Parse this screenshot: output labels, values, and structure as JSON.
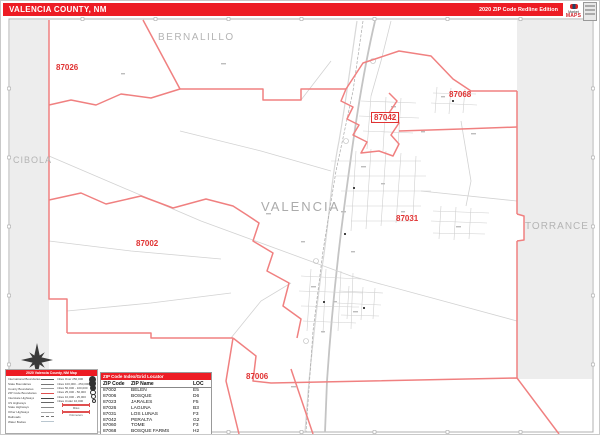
{
  "header": {
    "title": "VALENCIA COUNTY, NM",
    "edition": "2020 ZIP Code Redline Edition"
  },
  "logo": {
    "brand_top": "Market",
    "brand_bottom": "MAPS"
  },
  "map": {
    "county_labels": [
      {
        "id": "bernalillo",
        "text": "BERNALILLO"
      },
      {
        "id": "cibola",
        "text": "CIBOLA"
      },
      {
        "id": "torrance",
        "text": "TORRANCE"
      },
      {
        "id": "valencia",
        "text": "VALENCIA"
      }
    ],
    "zip_labels": [
      {
        "id": "87026",
        "text": "87026"
      },
      {
        "id": "87042",
        "text": "87042"
      },
      {
        "id": "87068",
        "text": "87068"
      },
      {
        "id": "87031",
        "text": "87031"
      },
      {
        "id": "87002",
        "text": "87002"
      },
      {
        "id": "87006",
        "text": "87006"
      }
    ]
  },
  "legend": {
    "title": "2020 Valencia County, NM Map",
    "left_items": [
      "International Boundaries",
      "State Boundaries",
      "County Boundaries",
      "ZIP Code Boundaries",
      "Interstate Highways",
      "US Highways",
      "State Highways",
      "Other Highways",
      "Railroads",
      "Water Bodies"
    ],
    "city_items": [
      "Cities Over 250,000",
      "Cities 100,000 - 250,000",
      "Cities 50,000 - 100,000",
      "Cities 25,000 - 50,000",
      "Cities 10,000 - 25,000",
      "Cities Under 10,000"
    ],
    "scale_labels": [
      "Miles",
      "Kilometers"
    ]
  },
  "zip_table": {
    "header": "ZIP Code Index/Grid Locator",
    "columns": [
      "ZIP Code",
      "ZIP Name",
      "LOC"
    ],
    "rows": [
      [
        "87002",
        "BELEN",
        "E5"
      ],
      [
        "87006",
        "BOSQUE",
        "D6"
      ],
      [
        "87023",
        "JARALES",
        "F5"
      ],
      [
        "87026",
        "LAGUNA",
        "B3"
      ],
      [
        "87031",
        "LOS LUNAS",
        "F3"
      ],
      [
        "87042",
        "PERALTA",
        "G2"
      ],
      [
        "87060",
        "TOME",
        "F3"
      ],
      [
        "87068",
        "BOSQUE FARMS",
        "H2"
      ]
    ]
  },
  "colors": {
    "accent_red": "#ed1c24",
    "boundary_red": "#f08080",
    "zip_label_red": "#e03232",
    "outside_gray": "#ededed",
    "county_label_gray": "#b4b4b4"
  }
}
